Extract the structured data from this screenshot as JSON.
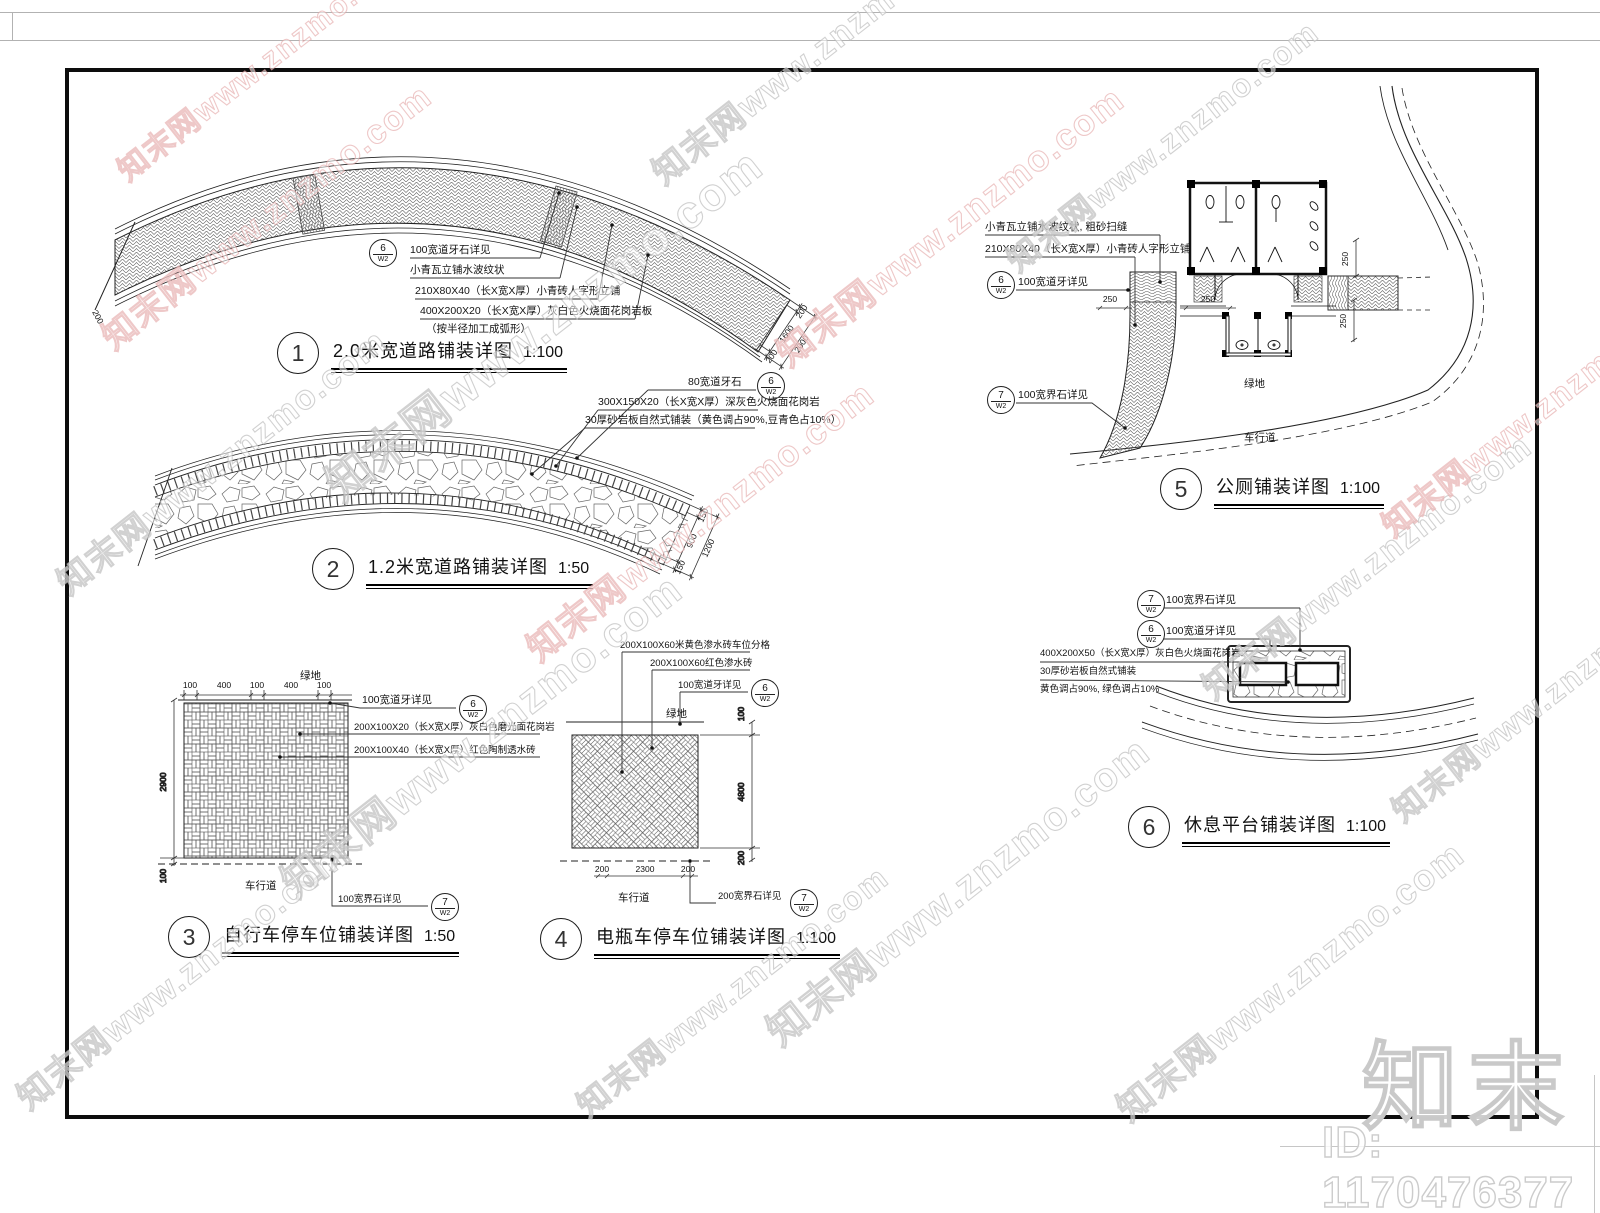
{
  "labels": {
    "green": "绿地",
    "road": "车行道"
  },
  "bubble": {
    "b6": "6",
    "b7": "7",
    "sheet": "W2"
  },
  "wm": {
    "diag": "知末网www.znzmo.com",
    "logo": "知末",
    "id": "ID: 1170476377"
  },
  "d1": {
    "no": "1",
    "title": "2.0米宽道路铺装详图",
    "scale": "1:100",
    "c1": "100宽道牙石详见",
    "c2": "小青瓦立铺水波纹状",
    "c3": "210X80X40（长X宽X厚）小青砖人字形立铺",
    "c4": "400X200X20（长X宽X厚）灰白色火烧面花岗岩板",
    "c5": "（按半径加工成弧形）",
    "dims": {
      "a": "200",
      "b": "1600",
      "c": "200",
      "total": "2000",
      "left": "200"
    }
  },
  "d2": {
    "no": "2",
    "title": "1.2米宽道路铺装详图",
    "scale": "1:50",
    "c1": "80宽道牙石",
    "c2": "300X150X20（长X宽X厚）深灰色火烧面花岗岩",
    "c3": "30厚砂岩板自然式铺装（黄色调占90%,豆青色占10%）",
    "dims": {
      "a": "150",
      "b": "900",
      "c": "150",
      "total": "1200"
    }
  },
  "d3": {
    "no": "3",
    "title": "自行车停车位铺装详图",
    "scale": "1:50",
    "c1": "100宽道牙详见",
    "c2": "200X100X20（长X宽X厚）灰白色磨光面花岗岩",
    "c3": "200X100X40（长X宽X厚）红色陶制透水砖",
    "c4": "100宽界石详见",
    "dims": {
      "w1": "100",
      "w2": "400",
      "w3": "100",
      "w4": "400",
      "w5": "100",
      "h": "2900",
      "h2": "100"
    }
  },
  "d4": {
    "no": "4",
    "title": "电瓶车停车位铺装详图",
    "scale": "1:100",
    "c1": "200X100X60米黄色渗水砖车位分格",
    "c2": "200X100X60红色渗水砖",
    "c3": "100宽道牙详见",
    "c4": "200宽界石详见",
    "dims": {
      "top": "100",
      "mid": "4800",
      "bot": "200",
      "b1": "200",
      "b2": "2300",
      "b3": "200"
    }
  },
  "d5": {
    "no": "5",
    "title": "公厕铺装详图",
    "scale": "1:100",
    "c1": "小青瓦立铺水波纹状, 粗砂扫缝",
    "c2": "210X80X40（长X宽X厚）小青砖人字形立铺",
    "c3": "100宽道牙详见",
    "c4": "100宽界石详见",
    "dims": {
      "a": "250",
      "b": "250",
      "c": "250",
      "d": "250"
    }
  },
  "d6": {
    "no": "6",
    "title": "休息平台铺装详图",
    "scale": "1:100",
    "c1": "100宽界石详见",
    "c2": "100宽道牙详见",
    "c3": "400X200X50（长X宽X厚）灰白色火烧面花岗岩",
    "c4": "30厚砂岩板自然式铺装",
    "c5": "黄色调占90%, 绿色调占10%"
  }
}
